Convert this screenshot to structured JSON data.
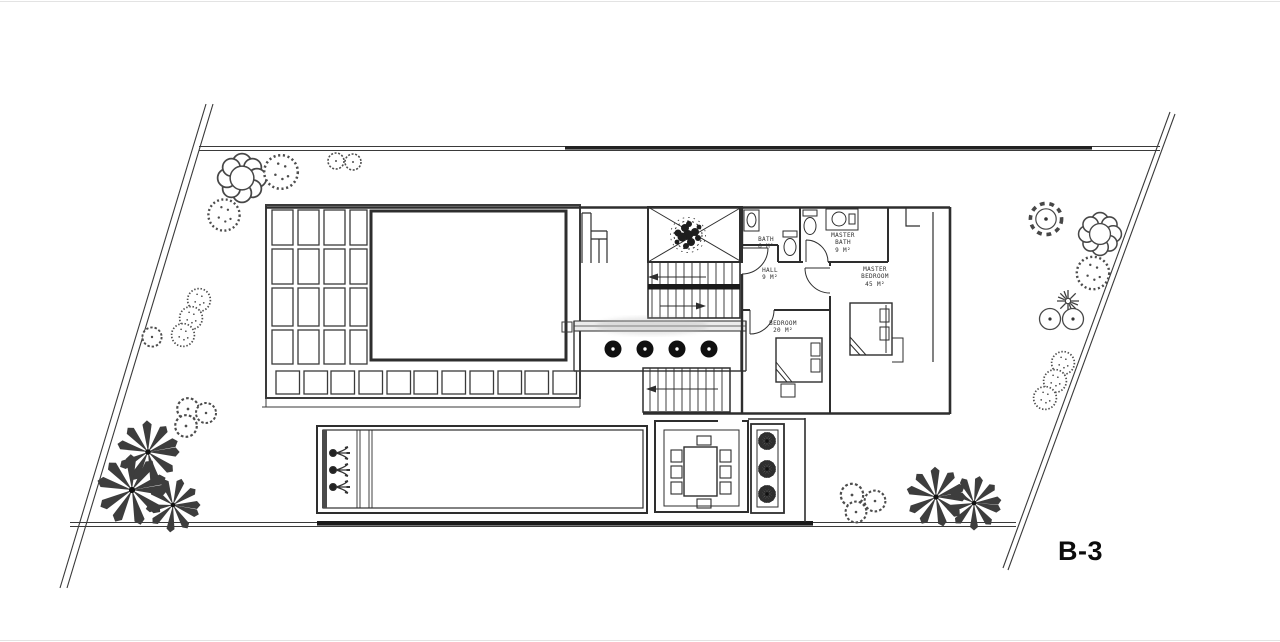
{
  "sheet": {
    "label": "B-3"
  },
  "rooms": [
    {
      "name": "BATH",
      "area": "6 M²"
    },
    {
      "name": "MASTER BATH",
      "area": "9 M²"
    },
    {
      "name": "HALL",
      "area": "9 M²"
    },
    {
      "name": "MASTER BEDROOM",
      "area": "45 M²"
    },
    {
      "name": "BEDROOM",
      "area": "20 M²"
    }
  ],
  "colors": {
    "ink": "#2e2e2e",
    "paper": "#ffffff",
    "dark_fill": "#1a1a1a"
  }
}
